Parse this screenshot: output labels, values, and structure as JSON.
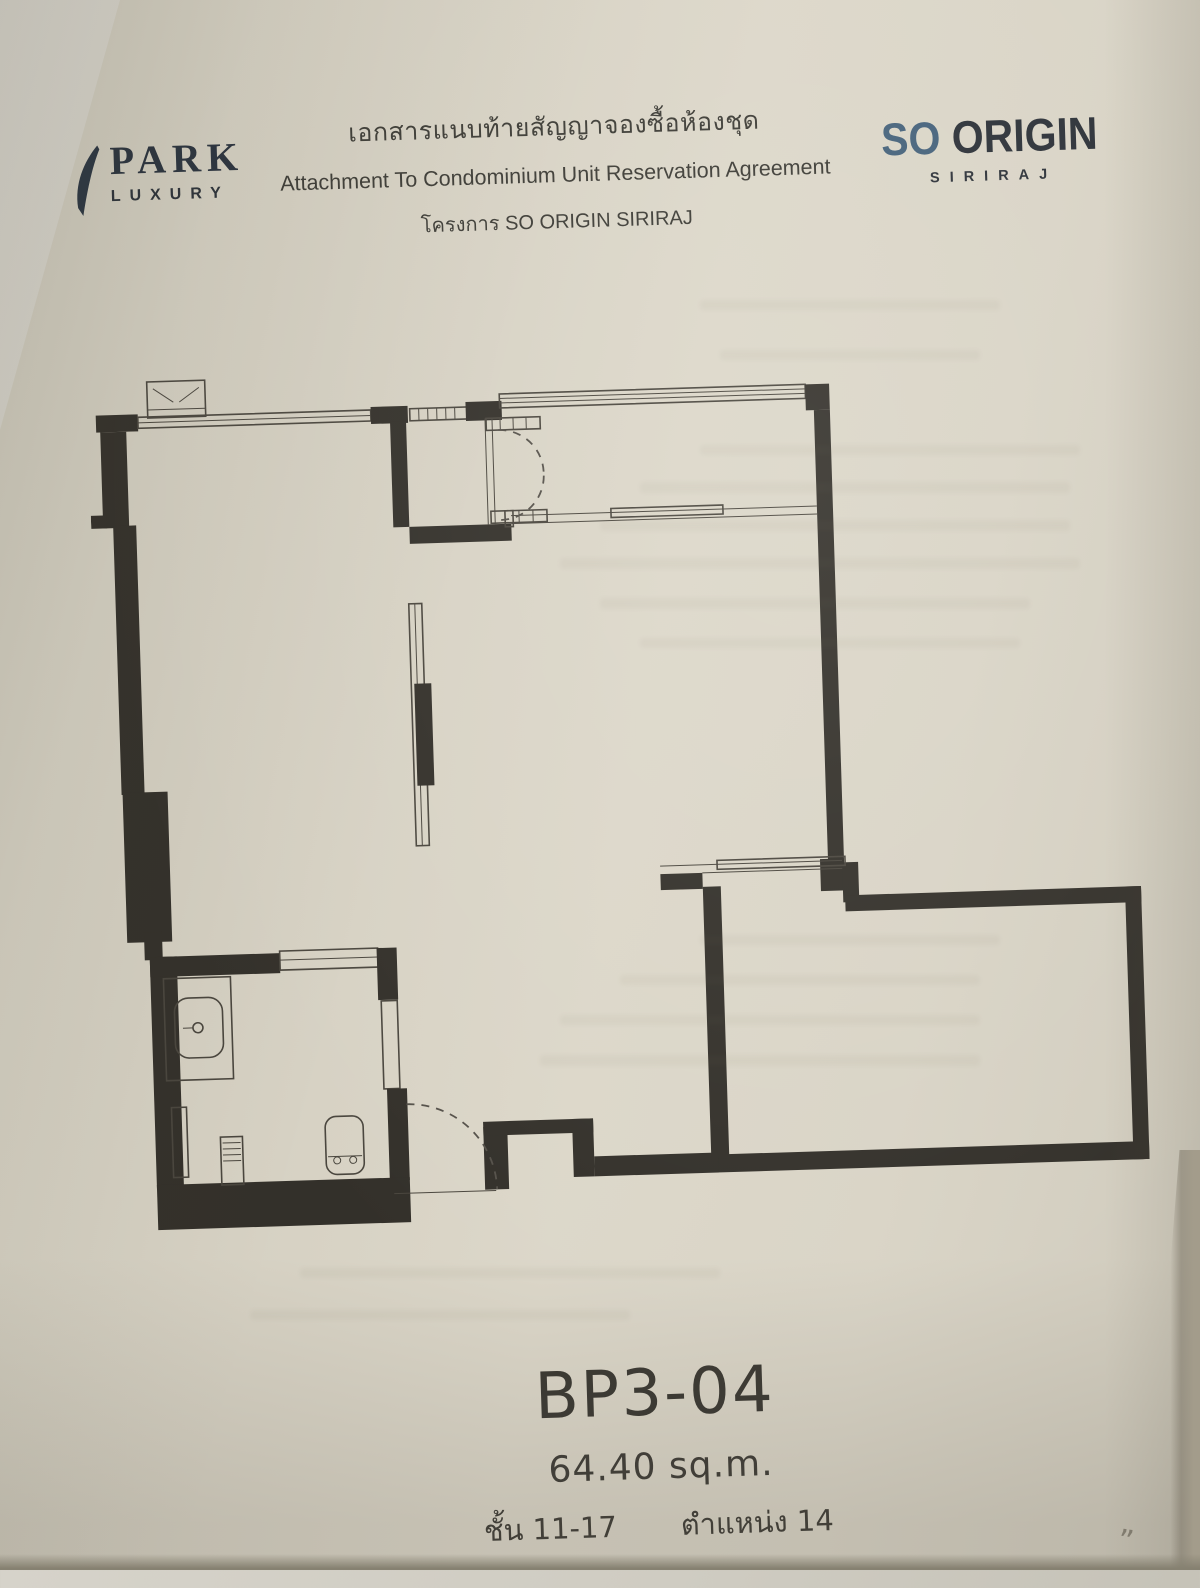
{
  "document": {
    "brand_left": {
      "name": "PARK",
      "sub": "LUXURY"
    },
    "header": {
      "title_th": "เอกสารแนบท้ายสัญญาจองซื้อห้องชุด",
      "title_en": "Attachment To Condominium Unit Reservation Agreement",
      "project_th": "โครงการ  SO ORIGIN SIRIRAJ"
    },
    "brand_right": {
      "name_primary": "SO",
      "name_secondary": " ORIGIN",
      "sub": "SIRIRAJ"
    },
    "unit": {
      "type": "BP3-04",
      "area": "64.40 sq.m.",
      "floor": "ชั้น 11-17",
      "position": "ตำแหน่ง 14"
    },
    "handwritten_mark": "”",
    "colors": {
      "paper": "#d8d3c5",
      "ink": "#35332d",
      "wall": "#33302a",
      "brand_blue": "#44617a",
      "brand_dark": "#2b3037"
    }
  }
}
